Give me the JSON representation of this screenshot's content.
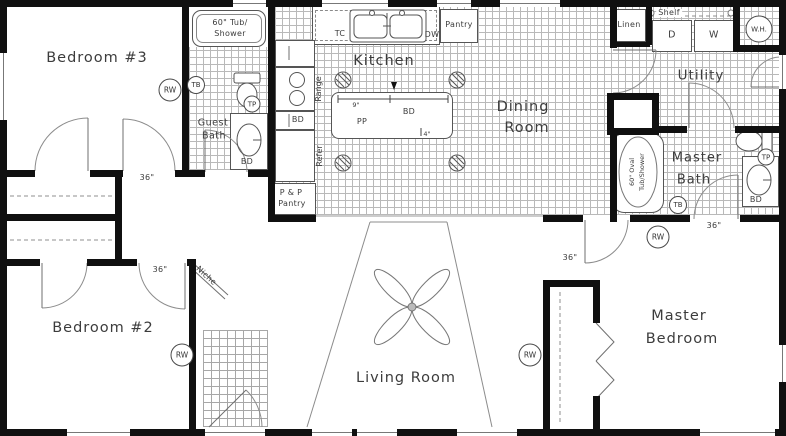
{
  "rooms": {
    "bedroom3": "Bedroom #3",
    "bedroom2": "Bedroom #2",
    "master_bedroom_1": "Master",
    "master_bedroom_2": "Bedroom",
    "living": "Living Room",
    "kitchen": "Kitchen",
    "dining_1": "Dining",
    "dining_2": "Room",
    "utility": "Utility",
    "master_bath_1": "Master",
    "master_bath_2": "Bath",
    "guest_bath_1": "Guest",
    "guest_bath_2": "Bath",
    "niche": "Niche"
  },
  "fixtures": {
    "guest_tub_1": "60\" Tub/",
    "guest_tub_2": "Shower",
    "master_tub_1": "60\" Oval",
    "master_tub_2": "Tub/Shower",
    "tc": "TC",
    "dw": "DW",
    "pantry": "Pantry",
    "range": "Range",
    "refer": "Refer",
    "bd": "BD",
    "pp": "PP",
    "pp_pantry_1": "P & P",
    "pp_pantry_2": "Pantry",
    "linen": "Linen",
    "shelf": "Shelf",
    "dryer": "D",
    "washer": "W",
    "water_heater": "W.H."
  },
  "markers": {
    "rw": "RW",
    "tb": "TB",
    "tp": "TP"
  },
  "dims": {
    "door": "36\"",
    "island_top": "9\"",
    "island_bottom": "4\""
  }
}
